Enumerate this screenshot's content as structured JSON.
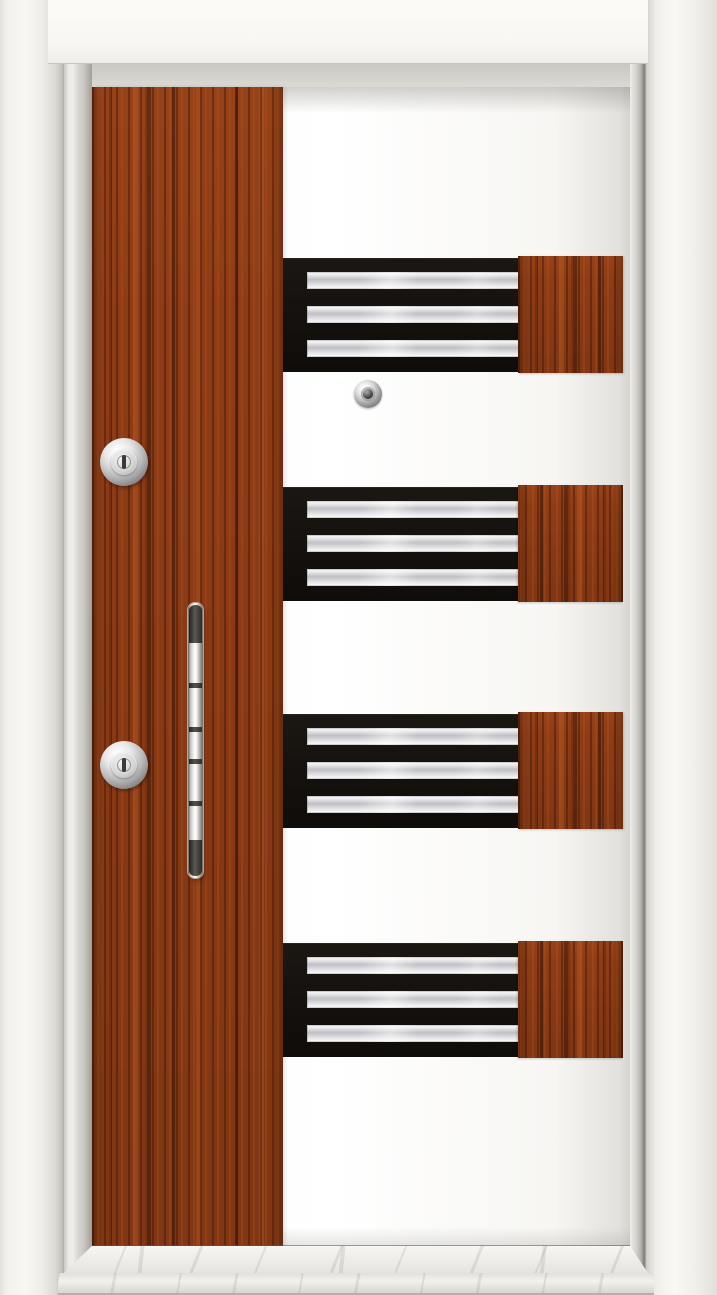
{
  "description": "Product photograph of a modern steel security door, front view: white lacquer frame and leaf, vertical rosewood laminate stile on the hinge side with two chrome lock cylinders and a long vertical chrome pull handle, four horizontal black grille panels each holding three stainless-steel slats and ending in a rosewood accent block, a chrome peephole, and a white marble threshold at the bottom.",
  "scene": {
    "subject": "steel security door",
    "view": "front",
    "text_visible": "none"
  },
  "door": {
    "panels": {
      "count": 4,
      "slats_per_panel": 3
    },
    "hardware": {
      "lock_cylinders": 2,
      "peephole": 1,
      "handle": "vertical chrome pull bar"
    }
  },
  "colors": {
    "casing": "#f2f0ec",
    "casing-deep": "#aeaca6",
    "header": "#fbfaf7",
    "reveal": "#dcdad5",
    "gap-line": "#7d7b74",
    "leaf-white": "#ffffff",
    "wood-base": "#8e3c15",
    "panel-black": "#0f0c09",
    "steel-light": "#fbfbfc",
    "steel-dark": "#bfbfc4",
    "chrome-light": "#f5f5f4",
    "chrome-dark": "#6e6e6a",
    "marble": "#eceae7",
    "marble-shade": "#dcdad5"
  }
}
